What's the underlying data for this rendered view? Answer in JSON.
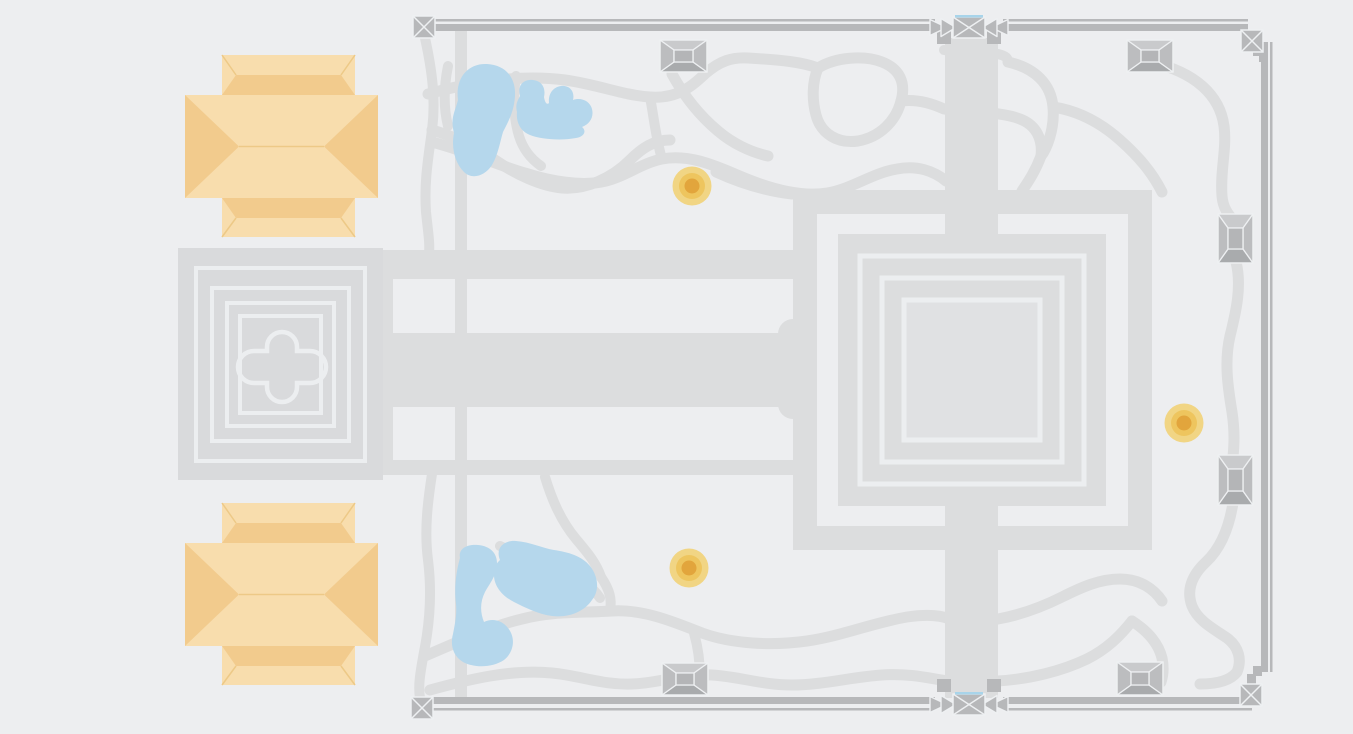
{
  "map": {
    "colors": {
      "background": "#edeef0",
      "path": "#dcddde",
      "temple_fill": "#d9dadc",
      "platform_fill": "#dcddde",
      "courtyard_fill": "#e0e1e3",
      "outline": "#eceef0",
      "wall": "#b7b8ba",
      "tower_body": "#b4b5b7",
      "tower_light": "#c9cacc",
      "tower_dark": "#a9abad",
      "tower_side": "#bcbdbf",
      "tower_line": "#eef0f2",
      "pond": "#b5d7ec",
      "moat": "#a8d4ea",
      "building_base": "#f8ddad",
      "building_facet": "#f2cb8d",
      "building_seam": "#edc987",
      "marker_outer": "#f1d584",
      "marker_mid": "#eec55e",
      "marker_inner": "#e2a53c"
    },
    "markers": [
      {
        "x": 692,
        "y": 186
      },
      {
        "x": 1184,
        "y": 423
      },
      {
        "x": 689,
        "y": 568
      }
    ],
    "towers": [
      {
        "x": 660,
        "y": 40,
        "w": 47,
        "h": 32,
        "o": "h"
      },
      {
        "x": 1127,
        "y": 40,
        "w": 46,
        "h": 32,
        "o": "h"
      },
      {
        "x": 662,
        "y": 663,
        "w": 46,
        "h": 32,
        "o": "h"
      },
      {
        "x": 1117,
        "y": 662,
        "w": 46,
        "h": 33,
        "o": "h"
      },
      {
        "x": 1218,
        "y": 214,
        "w": 35,
        "h": 49,
        "o": "v"
      },
      {
        "x": 1218,
        "y": 455,
        "w": 35,
        "h": 50,
        "o": "v"
      }
    ],
    "corner_gates": [
      {
        "x": 413,
        "y": 16
      },
      {
        "x": 1241,
        "y": 30
      },
      {
        "x": 411,
        "y": 697
      },
      {
        "x": 1240,
        "y": 684
      }
    ],
    "center_gates": [
      {
        "x": 953,
        "y": 17,
        "flip": false
      },
      {
        "x": 953,
        "y": 694,
        "flip": true
      }
    ],
    "buildings": [
      {
        "x": 185,
        "y": 55
      },
      {
        "x": 185,
        "y": 503
      }
    ],
    "ponds": [
      {
        "d": "M458,100 C455,78 468,63 487,64 C506,65 516,78 515,96 C514,112 508,122 503,132 C500,142 498,155 492,165 C485,176 472,180 464,172 C455,163 451,148 454,133 C450,118 455,112 458,100 Z"
      },
      {
        "d": "M520,96 C517,85 524,79 533,80 C542,81 546,88 544,97 C545,103 547,105 549,103 C548,94 553,87 561,86 C570,85 575,92 573,100 C581,97 590,101 592,109 C594,117 590,124 582,127 C587,131 584,137 576,138 C560,141 540,139 530,135 C520,131 516,122 517,112 C515,104 518,100 520,96 Z"
      },
      {
        "d": "M460,558 C458,548 468,544 478,545 C490,546 497,553 497,563 C497,575 490,583 485,592 C480,602 480,612 484,622 C492,618 502,620 508,628 C516,638 514,652 504,660 C492,668 474,668 463,662 C453,656 450,645 453,634 C455,624 457,614 456,604 C454,588 456,572 460,558 Z"
      },
      {
        "d": "M500,560 C495,548 504,540 516,541 C530,542 542,548 554,550 C568,552 582,556 590,566 C598,576 600,590 592,600 C584,612 568,618 552,616 C538,614 526,608 514,602 C502,596 494,586 494,575 C493,568 496,564 500,560 Z"
      }
    ],
    "trails": [
      {
        "d": "M425,38 C432,70 436,100 432,130 C428,160 424,182 426,212 C428,232 430,242 429,254",
        "w": 10
      },
      {
        "d": "M432,474 C428,500 424,530 428,560 C432,592 430,622 424,652 C420,674 418,686 420,698",
        "w": 10
      },
      {
        "d": "M432,130 C460,138 480,150 498,162 C516,174 540,186 562,188 C586,190 612,178 630,160 C642,148 654,140 670,140",
        "w": 11
      },
      {
        "d": "M428,94 C470,82 520,74 565,80 C600,85 622,95 650,97 C678,99 692,86 706,73 C720,61 732,57 748,58 C782,60 802,62 818,68",
        "w": 11
      },
      {
        "d": "M818,68 C836,57 864,55 882,62 C900,69 906,83 901,101 C896,121 880,137 858,141 C838,144 821,134 816,115 C812,100 812,82 818,68",
        "w": 11
      },
      {
        "d": "M901,101 C916,99 931,103 944,109 C970,113 1000,111 1020,119 C1036,125 1043,139 1041,156",
        "w": 11
      },
      {
        "d": "M1041,156 C1035,172 1028,182 1022,191",
        "w": 11
      },
      {
        "d": "M1008,62 C1035,68 1051,84 1053,107 C1055,130 1046,150 1041,156",
        "w": 11
      },
      {
        "d": "M944,50 C960,53 980,50 998,54 C1006,56 1008,58 1008,62",
        "w": 10
      },
      {
        "d": "M1053,107 C1080,111 1102,124 1120,140 C1138,156 1152,172 1162,192",
        "w": 11
      },
      {
        "d": "M432,142 C470,152 500,166 525,173 C550,181 582,187 606,181 C626,176 642,163 662,159 C692,153 722,169 747,179 C772,189 802,197 827,193 C852,189 872,173 897,169 C917,165 934,171 946,181",
        "w": 11
      },
      {
        "d": "M672,74 C684,96 700,116 718,131 C732,143 750,152 768,156",
        "w": 11
      },
      {
        "d": "M650,97 C654,118 656,139 662,159",
        "w": 10
      },
      {
        "d": "M716,172 C740,183 766,191 792,194",
        "w": 11
      },
      {
        "d": "M516,76 C513,96 513,116 519,136 C523,149 531,159 541,166",
        "w": 10
      },
      {
        "d": "M1150,62 C1196,72 1220,96 1224,126 C1227,149 1220,170 1222,196 C1223,208 1228,214 1233,220",
        "w": 11
      },
      {
        "d": "M1236,262 C1242,286 1236,312 1230,336 C1224,362 1228,388 1232,412 C1235,432 1234,446 1233,457",
        "w": 11
      },
      {
        "d": "M1233,503 C1229,528 1221,548 1206,562 C1192,575 1186,590 1192,606 C1198,621 1214,629 1227,638 C1239,647 1242,660 1237,672 C1230,681 1216,684 1200,684",
        "w": 11
      },
      {
        "d": "M425,656 C460,641 492,626 522,619 C552,611 582,613 612,611 C642,609 672,621 702,633 C732,644 772,646 807,641 C842,636 872,623 907,617 C927,614 940,615 950,619",
        "w": 11
      },
      {
        "d": "M430,690 C470,679 512,669 552,673 C582,676 602,685 632,684 C662,683 682,673 712,675 C742,677 762,685 792,685 C822,685 852,677 882,675 C912,673 932,679 948,681",
        "w": 11
      },
      {
        "d": "M998,619 C1020,615 1042,607 1062,597 C1082,587 1100,579 1120,579 C1140,579 1154,589 1162,601",
        "w": 11
      },
      {
        "d": "M998,681 C1030,679 1062,671 1087,659 C1107,649 1120,636 1132,621",
        "w": 11
      },
      {
        "d": "M545,477 C552,500 561,521 576,539 C586,551 596,562 601,577",
        "w": 10
      },
      {
        "d": "M601,577 C610,590 612,600 610,610",
        "w": 10
      },
      {
        "d": "M694,633 C699,651 701,669 699,687",
        "w": 10
      },
      {
        "d": "M500,546 C520,556 542,562 562,570 C580,577 592,586 600,598",
        "w": 10
      },
      {
        "d": "M1132,621 C1146,630 1158,642 1162,658 C1164,668 1163,676 1161,682",
        "w": 11
      },
      {
        "d": "M448,66 C444,86 443,106 448,126",
        "w": 10
      }
    ]
  }
}
